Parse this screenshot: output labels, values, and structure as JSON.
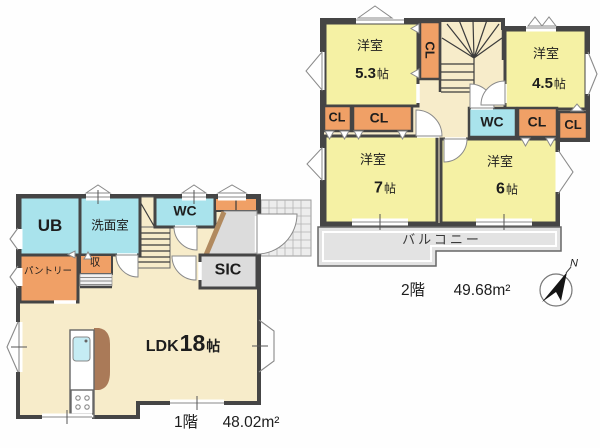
{
  "floor1": {
    "label": "1階",
    "area": "48.02m²",
    "rooms": {
      "ub": "UB",
      "washroom": "洗面室",
      "wc": "WC",
      "pantry": "パントリー",
      "closet": "収",
      "sic": "SIC",
      "ldk_label": "LDK",
      "ldk_size": "18",
      "ldk_unit": "帖"
    }
  },
  "floor2": {
    "label": "2階",
    "area": "49.68m²",
    "rooms": {
      "bedroom_tl_name": "洋室",
      "bedroom_tl_size": "5.3",
      "bedroom_tl_unit": "帖",
      "bedroom_tr_name": "洋室",
      "bedroom_tr_size": "4.5",
      "bedroom_tr_unit": "帖",
      "bedroom_bl_name": "洋室",
      "bedroom_bl_size": "7",
      "bedroom_bl_unit": "帖",
      "bedroom_br_name": "洋室",
      "bedroom_br_size": "6",
      "bedroom_br_unit": "帖",
      "cl_stairs": "CL",
      "cl_left_a": "CL",
      "cl_left_b": "CL",
      "wc": "WC",
      "cl_right_a": "CL",
      "cl_right_b": "CL",
      "balcony": "バルコニー"
    }
  },
  "compass": {
    "north": "N"
  },
  "colors": {
    "room_yellow": "#f5f1a4",
    "hall_cream": "#f7ecca",
    "water_cyan": "#a9e3ec",
    "closet_orange": "#f0a066",
    "floor_gray": "#dcdcdc",
    "balcony_gray": "#e3e3e3",
    "wall_dark": "#454545",
    "counter_brown": "#aa7a58"
  }
}
